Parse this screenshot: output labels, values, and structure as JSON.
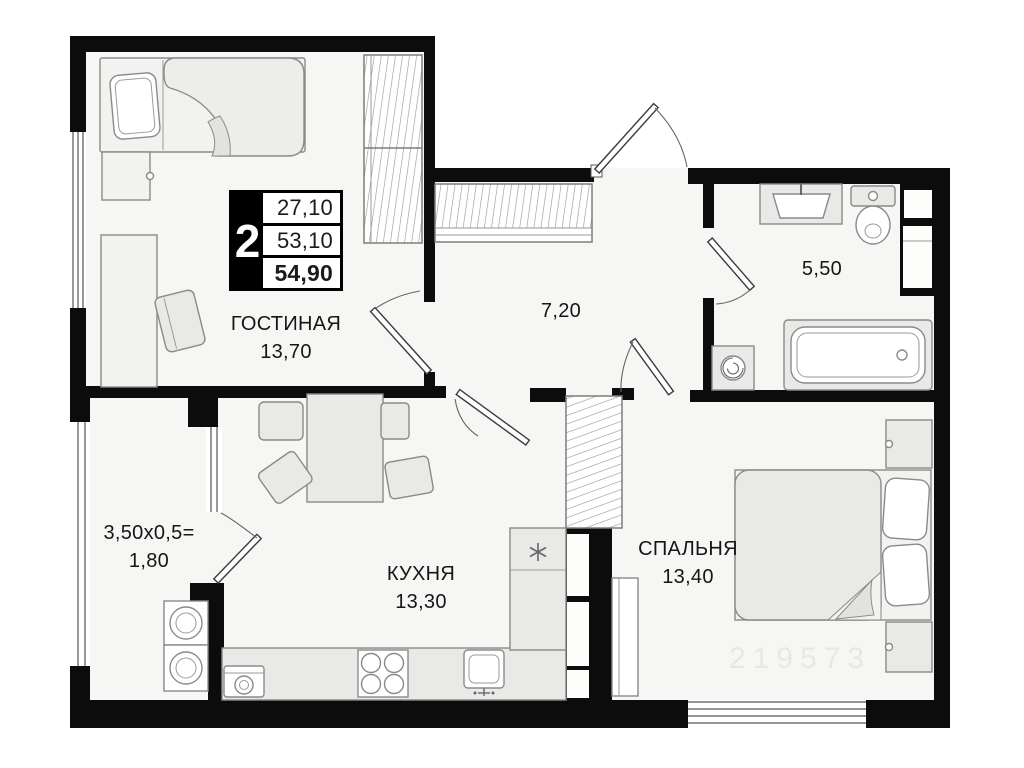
{
  "plan_info": {
    "rooms_count": "2",
    "living_area": "27,10",
    "apartment_area": "53,10",
    "total_area": "54,90"
  },
  "rooms": {
    "living": {
      "name": "ГОСТИНАЯ",
      "area": "13,70"
    },
    "hall": {
      "area": "7,20"
    },
    "bathroom": {
      "area": "5,50"
    },
    "balcony": {
      "formula": "3,50x0,5=",
      "area": "1,80"
    },
    "kitchen": {
      "name": "КУХНЯ",
      "area": "13,30"
    },
    "bedroom": {
      "name": "СПАЛЬНЯ",
      "area": "13,40"
    }
  },
  "watermark": "219573",
  "colors": {
    "wall": "#0c0c0c",
    "floor": "#f6f6f4",
    "furniture_fill": "#e9e9e7",
    "furniture_stroke": "#8a8a88"
  }
}
